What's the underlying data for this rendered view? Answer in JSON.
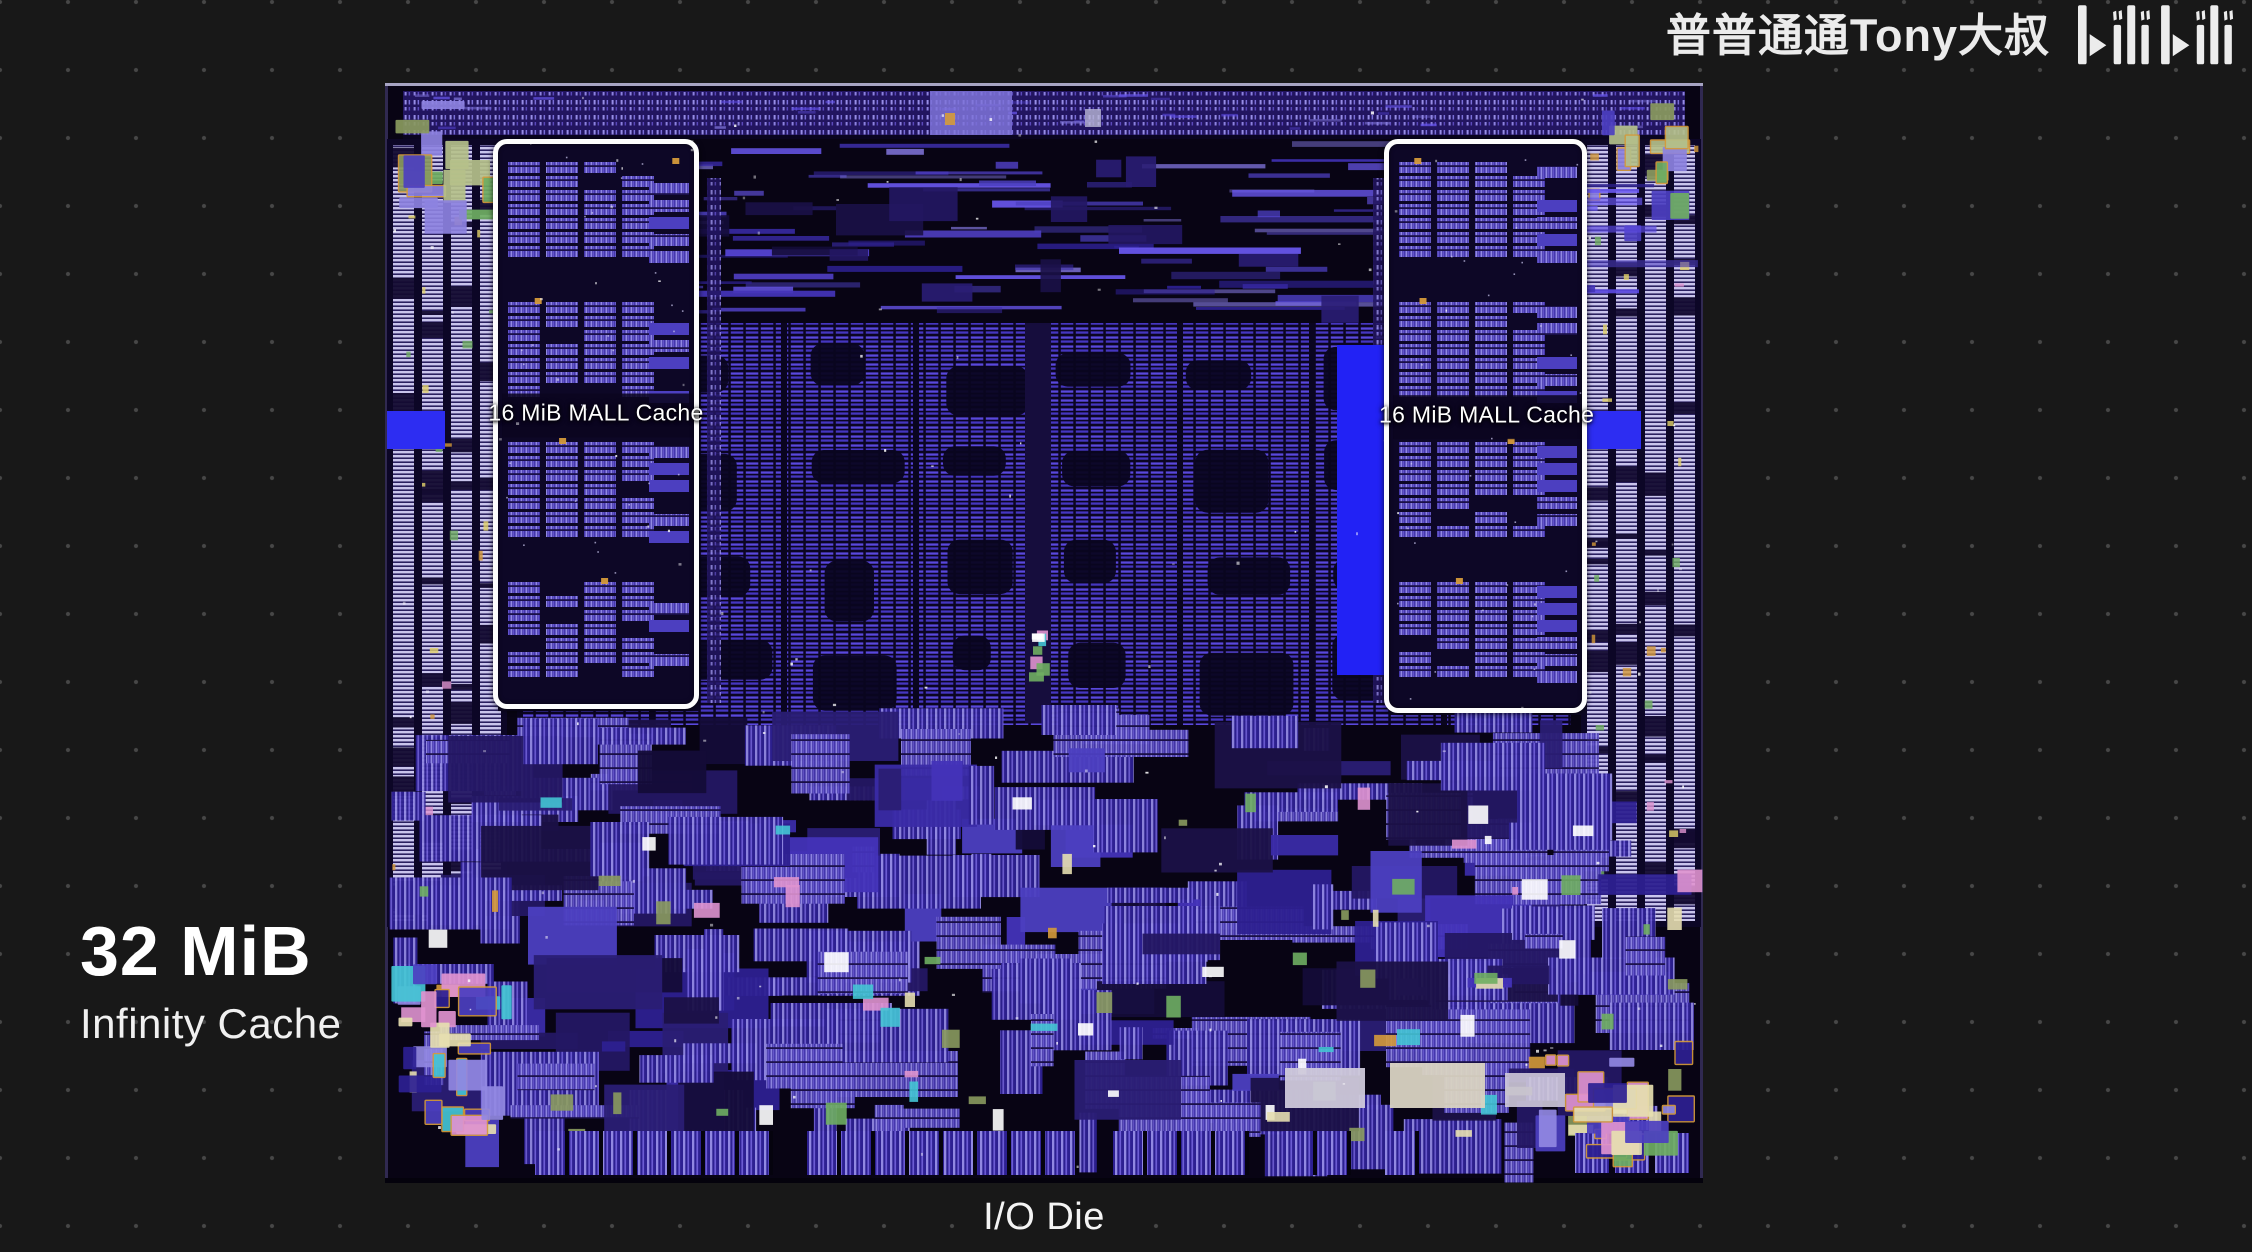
{
  "header": {
    "channel_name": "普普通通Tony大叔",
    "logo_text": "bilibili"
  },
  "annotations": {
    "cache_size": "32 MiB",
    "cache_name": "Infinity Cache",
    "die_caption": "I/O Die"
  },
  "die": {
    "mall_left_label": "16 MiB MALL Cache",
    "mall_right_label": "16 MiB MALL Cache"
  },
  "colors": {
    "page_background": "#181818",
    "dot_grid": "#474747",
    "die_background": "#05020d",
    "die_stripe_bright": "#5a48dd",
    "die_stripe_mid": "#4333b8",
    "phy_column_light": "#c9c4ec",
    "accent_blue_bar": "#2d2df2",
    "box_outline": "#fdfdfd",
    "text": "#ffffff"
  }
}
